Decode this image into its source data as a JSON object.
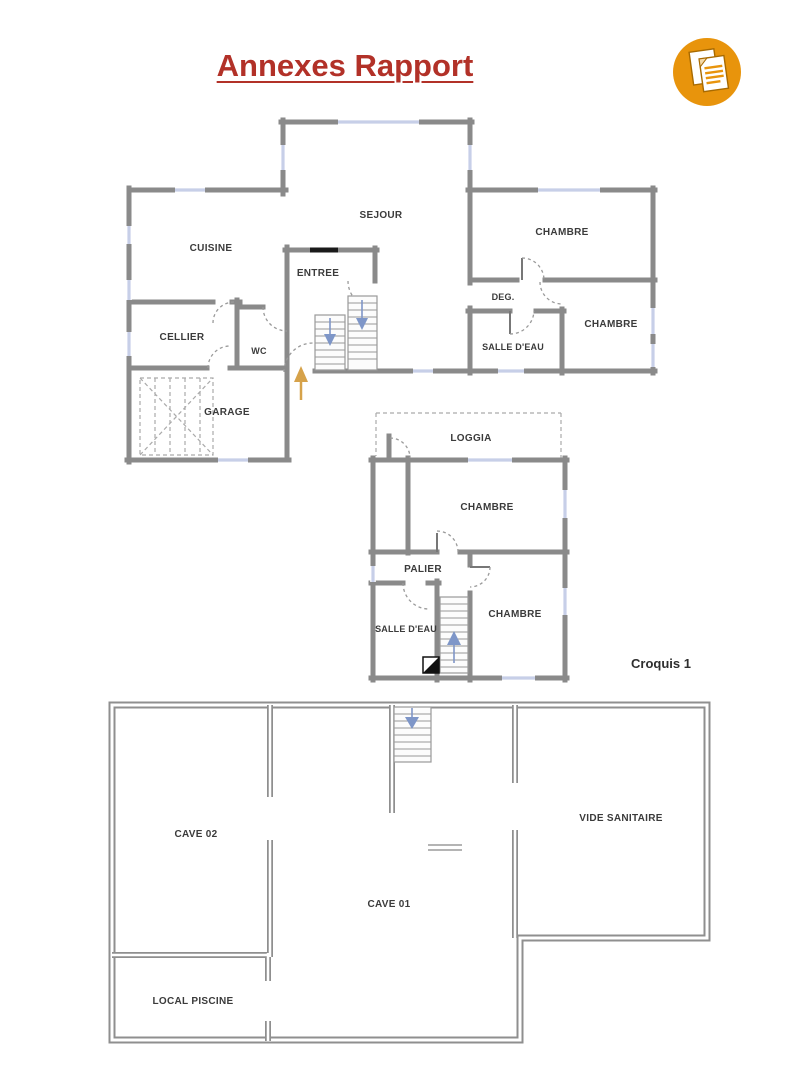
{
  "page": {
    "title": "Annexes Rapport",
    "caption": "Croquis 1"
  },
  "icon": {
    "name": "documents-icon"
  },
  "plans": {
    "rdc": {
      "rooms": {
        "sejour": "SEJOUR",
        "cuisine": "CUISINE",
        "entree": "ENTREE",
        "chambre_top": "CHAMBRE",
        "deg": "DEG.",
        "salle_eau": "SALLE D'EAU",
        "chambre_right": "CHAMBRE",
        "cellier": "CELLIER",
        "wc": "WC",
        "garage": "GARAGE"
      }
    },
    "etage": {
      "rooms": {
        "loggia": "LOGGIA",
        "chambre_top": "CHAMBRE",
        "palier": "PALIER",
        "salle_eau": "SALLE D'EAU",
        "chambre_bottom": "CHAMBRE"
      }
    },
    "sous_sol": {
      "rooms": {
        "cave_02": "CAVE 02",
        "vide_sanitaire": "VIDE SANITAIRE",
        "cave_01": "CAVE 01",
        "local_piscine": "LOCAL PISCINE"
      }
    }
  },
  "colors": {
    "title_red": "#B23128",
    "icon_orange": "#E8940C",
    "wall_gray": "#8A8A8A",
    "window_blue": "#C7CFE8",
    "stair_arrow_blue": "#7E96C8",
    "entrance_arrow_orange": "#D6A24A"
  }
}
